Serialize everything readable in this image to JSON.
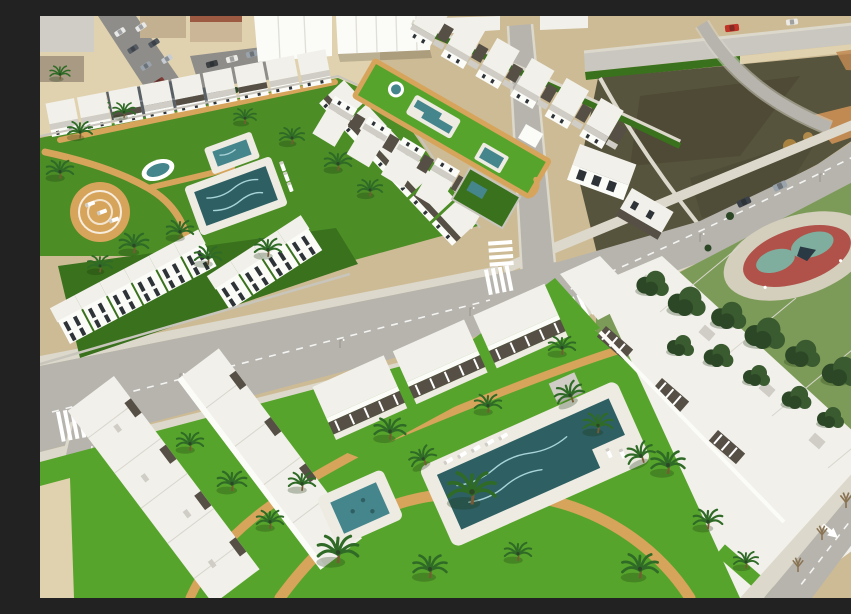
{
  "alt": "Aerial 3D architectural render of a coastal new-build residential complex: rows of white townhouses and apartment blocks with dark pergola roof terraces around landscaped communal gardens with turquoise swimming pools, palm trees and tan footpaths; an existing town block at top left, a vacant scrubland plot at top right, a public park with pine trees and a red-and-teal playground at the right, and light gray asphalt roads with crosswalks, cars and a white lane arrow crossing the scene.",
  "palette": {
    "sand": "#cdbb95",
    "sand_light": "#e0d2af",
    "road": "#b6b4ad",
    "road_light": "#c9c7c0",
    "asphalt": "#8e8d89",
    "sidewalk": "#dcd8cb",
    "white_roof": "#f1f0ea",
    "white_bright": "#fbfbf8",
    "roof_shadow": "#cfcdc5",
    "pergola": "#564f45",
    "wall_gray": "#c8c5bc",
    "lawn": "#4c8d26",
    "lawn_bright": "#57a42c",
    "lawn_dark": "#39711d",
    "park_grass": "#7d9b58",
    "scrub": "#57543d",
    "scrub_dark": "#474531",
    "dirt_orange": "#c08a52",
    "path_tan": "#d7a45b",
    "pool_deep": "#2e5f63",
    "pool_teal": "#45858c",
    "pool_light": "#a8d4d8",
    "pool_deck": "#edebe2",
    "palm_green": "#2f6b26",
    "palm_trunk": "#7a5a34",
    "pine": "#3a5a30",
    "pine_dark": "#2c4726",
    "play_red": "#b0524a",
    "play_teal": "#7fae9e",
    "apron": "#d4cebc",
    "car_red": "#c13327",
    "window_dark": "#2e3338",
    "white": "#ffffff"
  },
  "scene": {
    "existing_town": {
      "label": "existing town block",
      "features": [
        "gabled-roof house",
        "street with parked cars",
        "beige buildings",
        "white warehouse roofs"
      ]
    },
    "left_development": {
      "label": "townhouse development with communal garden",
      "features": [
        "main pool",
        "square plunge pool",
        "oval fountain pool",
        "round lounger terrace",
        "palm trees",
        "tan footpaths",
        "three townhouse rows"
      ]
    },
    "middle_development": {
      "label": "linear townhouse development",
      "features": [
        "long lawn strip",
        "lap pool",
        "round fountain",
        "square pool",
        "two facing townhouse rows",
        "detached villas with yard pool"
      ]
    },
    "foreground_development": {
      "label": "apartment blocks with pergola terraces",
      "features": [
        "large swimming pool with sun loungers",
        "kids pool",
        "many palm trees",
        "curved tan paths",
        "storage cube",
        "white roof blocks"
      ]
    },
    "vacant_lot": {
      "label": "undeveloped scrubland plot",
      "features": [
        "dirt patches",
        "access road"
      ]
    },
    "park": {
      "label": "public park",
      "features": [
        "pine trees",
        "playground with red track ring and teal pads",
        "lawn"
      ]
    },
    "roads": {
      "label": "road network",
      "features": [
        "main avenue",
        "junction with crosswalks",
        "top boulevard with red car",
        "corner road with white arrow",
        "street lights"
      ]
    }
  }
}
